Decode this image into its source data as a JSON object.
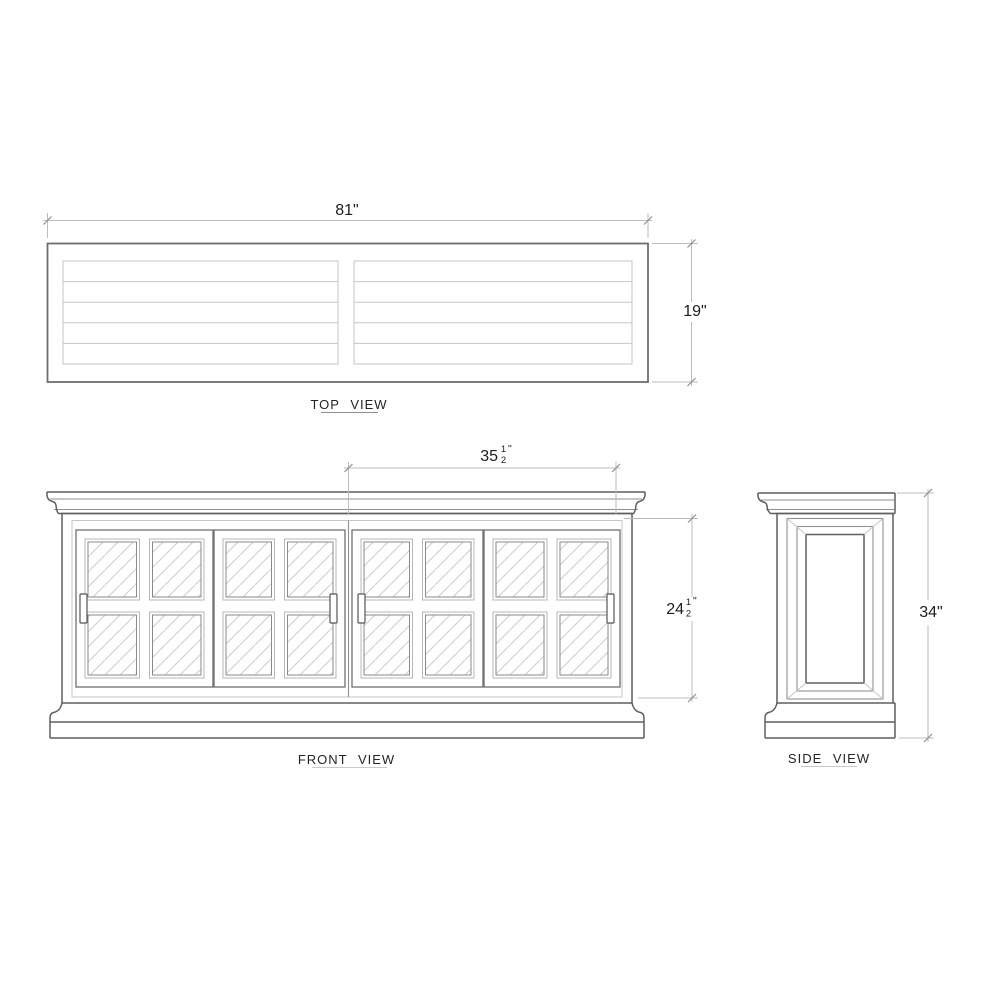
{
  "views": {
    "top": {
      "label": "TOP VIEW",
      "width_dim": "81\"",
      "depth_dim": "19\""
    },
    "front": {
      "label": "FRONT VIEW",
      "half_width_dim": {
        "whole": "35",
        "num": "1",
        "den": "2",
        "unit": "\""
      },
      "door_height_dim": {
        "whole": "24",
        "num": "1",
        "den": "2",
        "unit": "\""
      }
    },
    "side": {
      "label": "SIDE VIEW",
      "height_dim": "34\""
    }
  },
  "colors": {
    "outline": "#5f5f5f",
    "light_detail": "#c6c6c6",
    "dimension_line": "#bdbdbd",
    "glass_hatch": "#cdcdcd",
    "text": "#1d1d1d",
    "background": "#ffffff"
  }
}
